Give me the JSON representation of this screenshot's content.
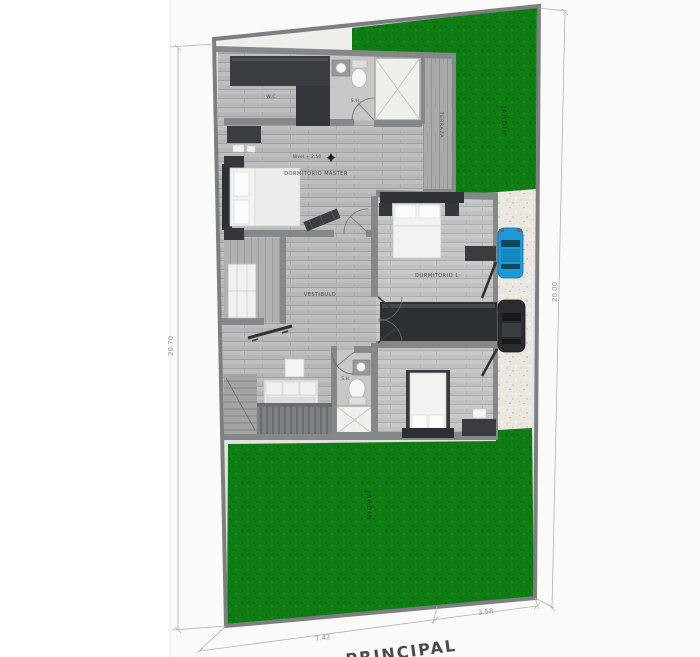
{
  "plan": {
    "labels": {
      "wc": "W.C.",
      "bath_master": "S.H.",
      "terrace": "TERRAZA",
      "master_bedroom": "DORMITORIO MASTER",
      "level_note": "Nivel + 2.50",
      "hall": "VESTIBULO",
      "bedroom_1": "DORMITORIO 1",
      "bath_2": "S.H.",
      "garden_top": "JARDIN",
      "garden_bottom": "JARDIN"
    },
    "dimensions": {
      "left": "20.70",
      "right": "20.00",
      "bottom_left": "7.42",
      "bottom_right": "3.58"
    },
    "street": "PRINCIPAL",
    "colors": {
      "grass": "#107c14",
      "floor_wood": "#b7b9b8",
      "wall": "#85888a",
      "dark_furniture": "#34373b",
      "driveway": "#eae7e0",
      "car_blue": "#1a9bd7",
      "car_black": "#2a2d30",
      "paper": "#fafaf8"
    }
  }
}
